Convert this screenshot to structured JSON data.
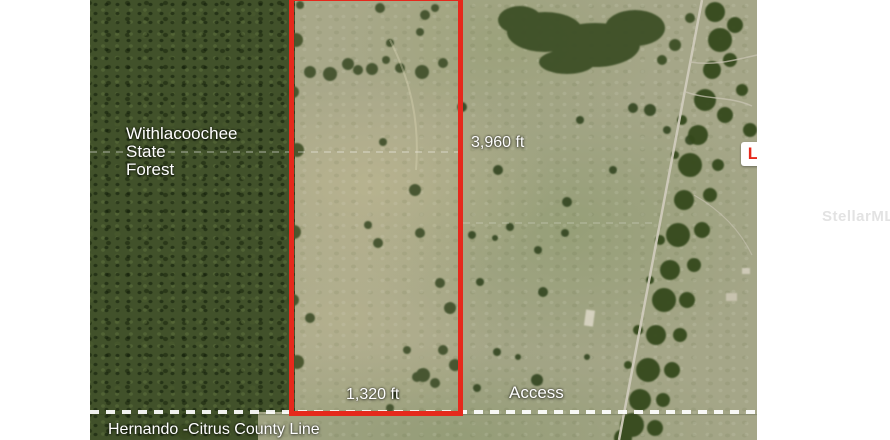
{
  "map": {
    "forest_label": "Withlacoochee\nState\nForest",
    "vertical_dim_label": "3,960 ft",
    "horizontal_dim_label": "1,320 ft",
    "access_label": "Access",
    "county_line_label": "Hernando -Citrus County Line",
    "road_label": "S Old Jones Rd",
    "marker_label": "L"
  },
  "colors": {
    "property_outline": "#e5291c",
    "county_dash": "#ffffff",
    "label_text": "#ffffff",
    "forest_green": "#41512a",
    "field_green": "#a5a688"
  },
  "watermark": {
    "text": "StellarMLS"
  }
}
